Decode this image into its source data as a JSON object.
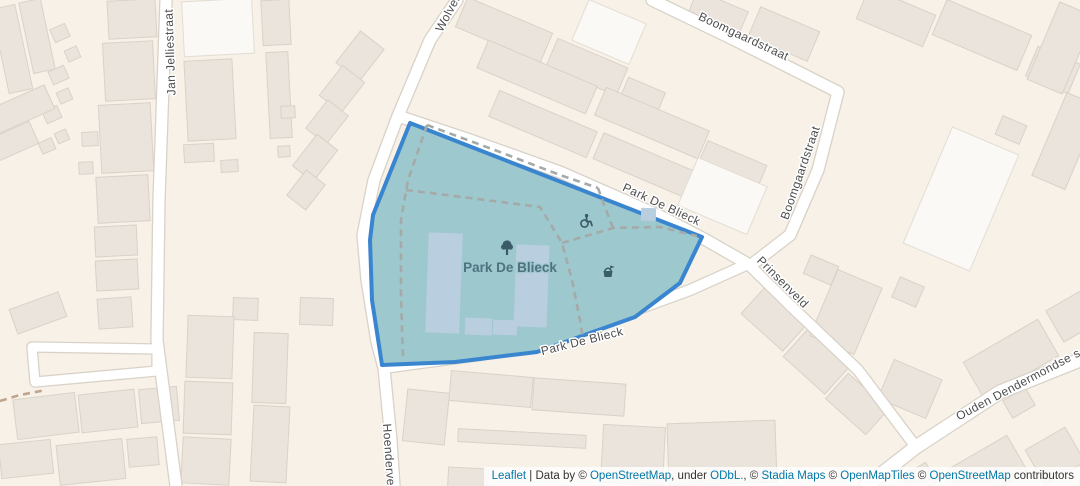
{
  "map": {
    "width": 1080,
    "height": 486,
    "colors": {
      "bg": "#f7f1e8",
      "building": "#eae4dc",
      "buildingBorder": "#d9d2c8",
      "buildingLight": "#faf9f6",
      "buildingLightBorder": "#e3ddd3",
      "road": "#ffffff",
      "roadCasing": "#d8d2c8",
      "parkFill": "#9dc8ce",
      "parkStroke": "#3a85d0",
      "pitch": "#b9cede",
      "pathGray": "#a4aaa7",
      "pathBrown": "#c0a48e",
      "label": "#4d4d4d",
      "halo": "#ffffff",
      "parkLabel": "#4e7280",
      "icon": "#3a5b68",
      "link": "#0078a8",
      "attrText": "#333333",
      "attrBg": "rgba(255,255,255,0.8)"
    },
    "park": {
      "name": "Park De Blieck",
      "label": {
        "text": "Park De Blieck",
        "x": 510,
        "y": 272
      },
      "polygon": [
        [
          410,
          123
        ],
        [
          702,
          237
        ],
        [
          680,
          283
        ],
        [
          635,
          317
        ],
        [
          537,
          352
        ],
        [
          455,
          362
        ],
        [
          382,
          365
        ],
        [
          372,
          300
        ],
        [
          370,
          240
        ],
        [
          373,
          215
        ]
      ],
      "pitches": [
        [
          427,
          233,
          34,
          100,
          2
        ],
        [
          515,
          245,
          33,
          82,
          2
        ],
        [
          465,
          318,
          27,
          17,
          2
        ],
        [
          493,
          320,
          24,
          15,
          2
        ],
        [
          641,
          208,
          15,
          13,
          2
        ]
      ],
      "icons": [
        {
          "type": "tree",
          "x": 507,
          "y": 250
        },
        {
          "type": "wheelchair",
          "x": 586,
          "y": 221
        },
        {
          "type": "playground",
          "x": 608,
          "y": 272
        }
      ]
    },
    "paths": [
      {
        "pts": [
          [
            427,
            125
          ],
          [
            408,
            180
          ],
          [
            401,
            220
          ],
          [
            401,
            300
          ],
          [
            403,
            358
          ]
        ],
        "c": "gray"
      },
      {
        "pts": [
          [
            406,
            190
          ],
          [
            470,
            198
          ],
          [
            540,
            207
          ],
          [
            562,
            243
          ],
          [
            572,
            280
          ],
          [
            580,
            320
          ],
          [
            584,
            346
          ]
        ],
        "c": "gray"
      },
      {
        "pts": [
          [
            562,
            243
          ],
          [
            613,
            228
          ],
          [
            660,
            227
          ],
          [
            697,
            236
          ]
        ],
        "c": "gray"
      },
      {
        "pts": [
          [
            613,
            228
          ],
          [
            603,
            202
          ],
          [
            598,
            188
          ]
        ],
        "c": "gray"
      },
      {
        "pts": [
          [
            427,
            125
          ],
          [
            500,
            152
          ],
          [
            560,
            175
          ],
          [
            598,
            188
          ]
        ],
        "c": "gray"
      },
      {
        "pts": [
          [
            0,
            401
          ],
          [
            20,
            395
          ],
          [
            46,
            390
          ]
        ],
        "c": "brown"
      }
    ],
    "roads": [
      {
        "id": "jan-jelliestraat",
        "pts": [
          [
            166,
            0
          ],
          [
            159,
            200
          ],
          [
            157,
            340
          ],
          [
            176,
            486
          ]
        ],
        "w": 11
      },
      {
        "id": "side-loop",
        "pts": [
          [
            157,
            349
          ],
          [
            32,
            347
          ],
          [
            35,
            382
          ],
          [
            157,
            371
          ]
        ],
        "w": 9,
        "closed": true
      },
      {
        "id": "wolven-hoenderve",
        "pts": [
          [
            457,
            0
          ],
          [
            430,
            40
          ],
          [
            398,
            116
          ],
          [
            374,
            180
          ],
          [
            363,
            235
          ],
          [
            367,
            280
          ],
          [
            377,
            342
          ],
          [
            384,
            368
          ],
          [
            391,
            440
          ],
          [
            394,
            486
          ]
        ],
        "w": 11
      },
      {
        "id": "park-de-blieck-north",
        "pts": [
          [
            398,
            116
          ],
          [
            470,
            140
          ],
          [
            560,
            172
          ],
          [
            660,
            216
          ],
          [
            706,
            240
          ],
          [
            748,
            264
          ]
        ],
        "w": 11
      },
      {
        "id": "park-de-blieck-south",
        "pts": [
          [
            748,
            264
          ],
          [
            690,
            290
          ],
          [
            630,
            312
          ],
          [
            560,
            340
          ],
          [
            480,
            355
          ],
          [
            420,
            363
          ],
          [
            384,
            368
          ]
        ],
        "w": 10
      },
      {
        "id": "boomgaardstraat",
        "pts": [
          [
            652,
            0
          ],
          [
            735,
            40
          ],
          [
            838,
            92
          ],
          [
            818,
            170
          ],
          [
            790,
            235
          ],
          [
            755,
            262
          ]
        ],
        "w": 11
      },
      {
        "id": "prinsenveld",
        "pts": [
          [
            748,
            264
          ],
          [
            795,
            310
          ],
          [
            858,
            370
          ],
          [
            916,
            447
          ]
        ],
        "w": 10
      },
      {
        "id": "ouden-dendermondse",
        "pts": [
          [
            866,
            486
          ],
          [
            916,
            447
          ],
          [
            1000,
            392
          ],
          [
            1080,
            360
          ]
        ],
        "w": 13
      }
    ],
    "street_labels": [
      {
        "text": "Jan Jelliestraat",
        "x": 174,
        "y": 52,
        "rot": -92
      },
      {
        "text": "Wolven",
        "x": 452,
        "y": 14,
        "rot": -62
      },
      {
        "text": "Boomgaardstraat",
        "x": 742,
        "y": 40,
        "rot": 25
      },
      {
        "text": "Boomgaardstraat",
        "x": 804,
        "y": 174,
        "rot": -71
      },
      {
        "text": "Park De Blieck",
        "x": 660,
        "y": 208,
        "rot": 25
      },
      {
        "text": "Prinsenveld",
        "x": 780,
        "y": 285,
        "rot": 45
      },
      {
        "text": "Park De Blieck",
        "x": 583,
        "y": 345,
        "rot": -14
      },
      {
        "text": "Hoenderve",
        "x": 385,
        "y": 455,
        "rot": 86
      },
      {
        "text": "Ouden Dendermondse s",
        "x": 1020,
        "y": 388,
        "rot": -28
      }
    ],
    "buildings": [
      [
        0,
        6,
        24,
        86,
        -12,
        0
      ],
      [
        26,
        0,
        22,
        72,
        -12,
        0
      ],
      [
        52,
        26,
        16,
        14,
        -24,
        0
      ],
      [
        66,
        48,
        13,
        12,
        -24,
        0
      ],
      [
        50,
        68,
        17,
        14,
        -24,
        0
      ],
      [
        58,
        90,
        13,
        12,
        -24,
        0
      ],
      [
        44,
        108,
        16,
        13,
        -24,
        0
      ],
      [
        56,
        131,
        12,
        11,
        -24,
        0
      ],
      [
        40,
        140,
        14,
        12,
        -24,
        0
      ],
      [
        -8,
        96,
        60,
        26,
        -24,
        0
      ],
      [
        -12,
        130,
        48,
        24,
        -24,
        0
      ],
      [
        108,
        0,
        48,
        38,
        -3,
        0
      ],
      [
        104,
        42,
        50,
        58,
        -3,
        0
      ],
      [
        100,
        104,
        52,
        68,
        -3,
        0
      ],
      [
        97,
        176,
        52,
        46,
        -3,
        0
      ],
      [
        95,
        226,
        42,
        30,
        -3,
        0
      ],
      [
        96,
        260,
        42,
        30,
        -3,
        0
      ],
      [
        82,
        132,
        16,
        14,
        -3,
        0
      ],
      [
        79,
        162,
        14,
        12,
        -3,
        0
      ],
      [
        183,
        0,
        70,
        55,
        -3,
        1
      ],
      [
        186,
        60,
        48,
        80,
        -3,
        0
      ],
      [
        184,
        144,
        30,
        18,
        -3,
        0
      ],
      [
        221,
        160,
        17,
        12,
        -3,
        0
      ],
      [
        262,
        0,
        28,
        45,
        -3,
        0
      ],
      [
        268,
        52,
        22,
        86,
        -3,
        0
      ],
      [
        281,
        106,
        14,
        12,
        -3,
        0
      ],
      [
        278,
        146,
        12,
        11,
        -3,
        0
      ],
      [
        345,
        36,
        30,
        40,
        38,
        0
      ],
      [
        328,
        70,
        28,
        38,
        38,
        0
      ],
      [
        314,
        104,
        26,
        36,
        38,
        0
      ],
      [
        302,
        138,
        26,
        40,
        38,
        0
      ],
      [
        294,
        174,
        24,
        32,
        38,
        0
      ],
      [
        458,
        14,
        92,
        32,
        23,
        0
      ],
      [
        549,
        52,
        76,
        30,
        23,
        0
      ],
      [
        578,
        10,
        62,
        44,
        23,
        1
      ],
      [
        622,
        84,
        40,
        26,
        23,
        0
      ],
      [
        478,
        62,
        118,
        30,
        23,
        0
      ],
      [
        596,
        108,
        112,
        30,
        23,
        0
      ],
      [
        700,
        152,
        64,
        28,
        23,
        0
      ],
      [
        490,
        110,
        106,
        28,
        23,
        0
      ],
      [
        594,
        154,
        114,
        28,
        23,
        0
      ],
      [
        685,
        170,
        75,
        52,
        23,
        1
      ],
      [
        690,
        0,
        55,
        28,
        23,
        0
      ],
      [
        752,
        18,
        64,
        32,
        23,
        0
      ],
      [
        860,
        0,
        72,
        34,
        23,
        0
      ],
      [
        936,
        16,
        92,
        38,
        23,
        0
      ],
      [
        1030,
        54,
        46,
        32,
        23,
        0
      ],
      [
        925,
        136,
        72,
        126,
        23,
        1
      ],
      [
        1042,
        6,
        38,
        84,
        23,
        0
      ],
      [
        1048,
        96,
        36,
        90,
        23,
        0
      ],
      [
        998,
        120,
        26,
        20,
        23,
        0
      ],
      [
        895,
        281,
        26,
        22,
        23,
        0
      ],
      [
        746,
        301,
        56,
        36,
        42,
        0
      ],
      [
        788,
        344,
        56,
        36,
        42,
        0
      ],
      [
        830,
        387,
        54,
        34,
        42,
        0
      ],
      [
        806,
        260,
        30,
        20,
        23,
        0
      ],
      [
        822,
        276,
        48,
        72,
        23,
        0
      ],
      [
        884,
        368,
        52,
        42,
        23,
        0
      ],
      [
        968,
        338,
        86,
        42,
        -30,
        0
      ],
      [
        1052,
        298,
        42,
        36,
        -30,
        0
      ],
      [
        1006,
        393,
        26,
        20,
        -30,
        0
      ],
      [
        952,
        450,
        70,
        42,
        -30,
        0
      ],
      [
        1032,
        436,
        46,
        40,
        -30,
        0
      ],
      [
        905,
        468,
        28,
        22,
        -30,
        0
      ],
      [
        405,
        391,
        42,
        52,
        6,
        0
      ],
      [
        450,
        374,
        82,
        30,
        5,
        0
      ],
      [
        533,
        381,
        92,
        32,
        4,
        0
      ],
      [
        458,
        432,
        128,
        13,
        3,
        0
      ],
      [
        448,
        468,
        40,
        24,
        3,
        0
      ],
      [
        602,
        426,
        62,
        58,
        3,
        0
      ],
      [
        668,
        422,
        108,
        62,
        -2,
        0
      ],
      [
        12,
        300,
        52,
        26,
        -20,
        0
      ],
      [
        98,
        298,
        34,
        30,
        -4,
        0
      ],
      [
        300,
        298,
        33,
        27,
        2,
        0
      ],
      [
        233,
        298,
        25,
        22,
        2,
        0
      ],
      [
        15,
        396,
        62,
        40,
        -7,
        0
      ],
      [
        80,
        392,
        56,
        38,
        -6,
        0
      ],
      [
        140,
        388,
        38,
        34,
        -5,
        0
      ],
      [
        0,
        442,
        52,
        34,
        -6,
        0
      ],
      [
        58,
        442,
        66,
        40,
        -6,
        0
      ],
      [
        128,
        438,
        30,
        28,
        -5,
        0
      ],
      [
        187,
        316,
        46,
        62,
        2,
        0
      ],
      [
        184,
        382,
        48,
        52,
        2,
        0
      ],
      [
        182,
        438,
        48,
        46,
        3,
        0
      ],
      [
        253,
        333,
        34,
        70,
        2,
        0
      ],
      [
        252,
        406,
        36,
        76,
        3,
        0
      ]
    ]
  },
  "attribution": {
    "parts": [
      {
        "text": "Leaflet",
        "link": true,
        "name": "leaflet"
      },
      {
        "text": " | Data by © ",
        "link": false
      },
      {
        "text": "OpenStreetMap",
        "link": true,
        "name": "openstreetmap"
      },
      {
        "text": ", under ",
        "link": false
      },
      {
        "text": "ODbL.",
        "link": true,
        "name": "odbl"
      },
      {
        "text": ", © ",
        "link": false
      },
      {
        "text": "Stadia Maps",
        "link": true,
        "name": "stadia-maps"
      },
      {
        "text": " © ",
        "link": false
      },
      {
        "text": "OpenMapTiles",
        "link": true,
        "name": "openmaptiles"
      },
      {
        "text": " © ",
        "link": false
      },
      {
        "text": "OpenStreetMap",
        "link": true,
        "name": "openstreetmap-contributors"
      },
      {
        "text": " contributors",
        "link": false
      }
    ]
  }
}
